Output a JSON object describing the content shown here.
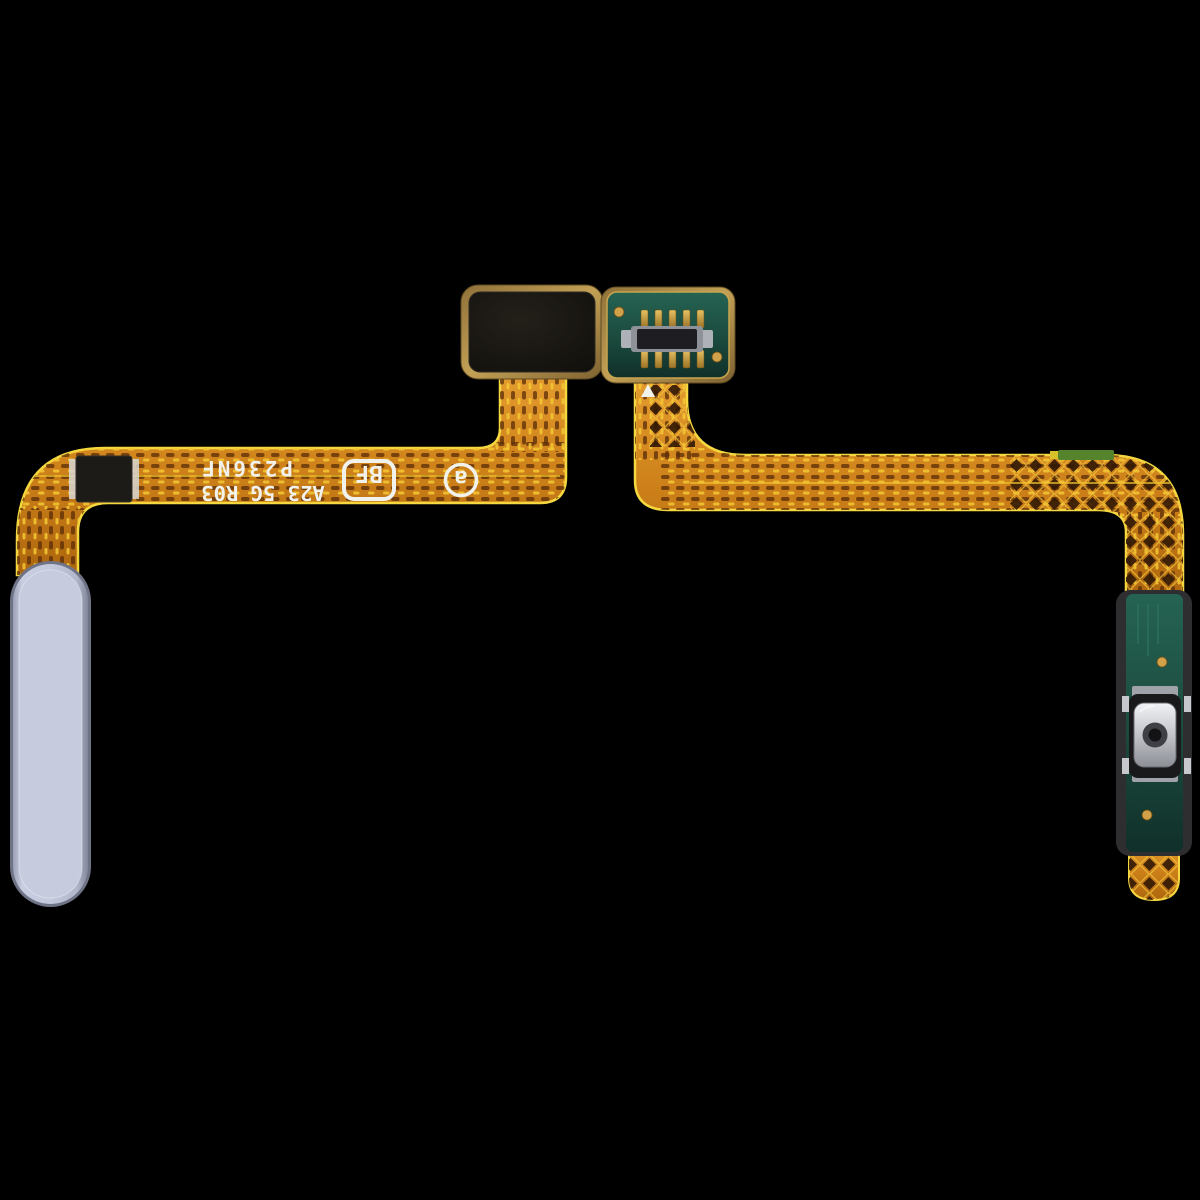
{
  "markings": {
    "line1": "A23 5G R03",
    "line2": "P236NF",
    "stamp_box": "BF",
    "stamp_circle": "a",
    "orientation": "rotated-180-upside-down"
  },
  "colors": {
    "background": "#000000",
    "flex_base": "#cd8019",
    "flex_edge": "#f5d840",
    "dash_dark": "#5a2c06",
    "dash_gold": "#f5c832",
    "pcb_green": "#1b4a3d",
    "pcb_gold_edge": "#c9a54e",
    "gold_pad": "#d2a24a",
    "connector_body": "#1e1e22",
    "metal": "#c6c8cd",
    "button_body": "#c6cbde",
    "button_rim": "#6f7386",
    "pad_black": "#17150f",
    "chip_black": "#1d1b18",
    "marking_white": "#f2f2ec",
    "patch_green": "#55842c"
  },
  "parts": [
    {
      "name": "black-foam-pad",
      "desc": "black adhesive pad on flex, top left"
    },
    {
      "name": "connector-pcb",
      "desc": "green PCB with board-to-board connector, top right"
    },
    {
      "name": "flex-cable-left-arm",
      "desc": "orange flex ribbon to power button"
    },
    {
      "name": "flex-cable-right-arm",
      "desc": "orange flex ribbon to switch PCB"
    },
    {
      "name": "power-button-cap",
      "desc": "light blue pill shaped side key"
    },
    {
      "name": "dome-switch-pcb",
      "desc": "green strip PCB with metal dome switch, bottom right"
    },
    {
      "name": "smd-chip",
      "desc": "small black component on left ribbon"
    }
  ]
}
